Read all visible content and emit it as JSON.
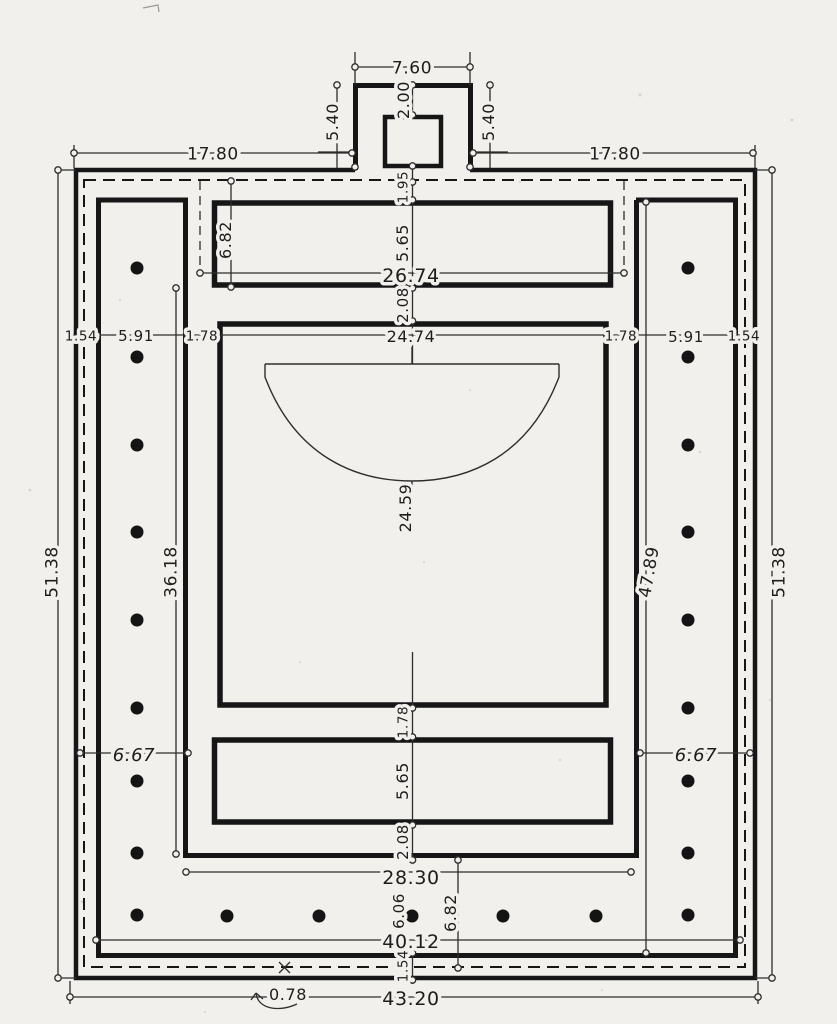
{
  "figure": {
    "type": "architectural-floor-plan",
    "style": "measured ink drawing on aged paper",
    "paper_color": "#f1f0ec",
    "ink_color": "#161616"
  },
  "dims": {
    "d7_60": "7.60",
    "d2_00": "2.00",
    "d5_40": "5.40",
    "d17_80": "17.80",
    "d1_95": "1.95",
    "d6_82": "6.82",
    "d5_65": "5.65",
    "d26_74": "26.74",
    "d2_08": "2.08",
    "d24_74": "24.74",
    "d1_78": "1.78",
    "d5_91": "5.91",
    "d1_54": "1.54",
    "d24_59": "24.59",
    "d51_38": "51.38",
    "d36_18": "36.18",
    "d47_89": "47.89",
    "d6_67": "6.67",
    "d28_30": "28.30",
    "d6_06": "6.06",
    "d40_12": "40.12",
    "d43_20": "43.20",
    "d0_78": "0.78"
  }
}
